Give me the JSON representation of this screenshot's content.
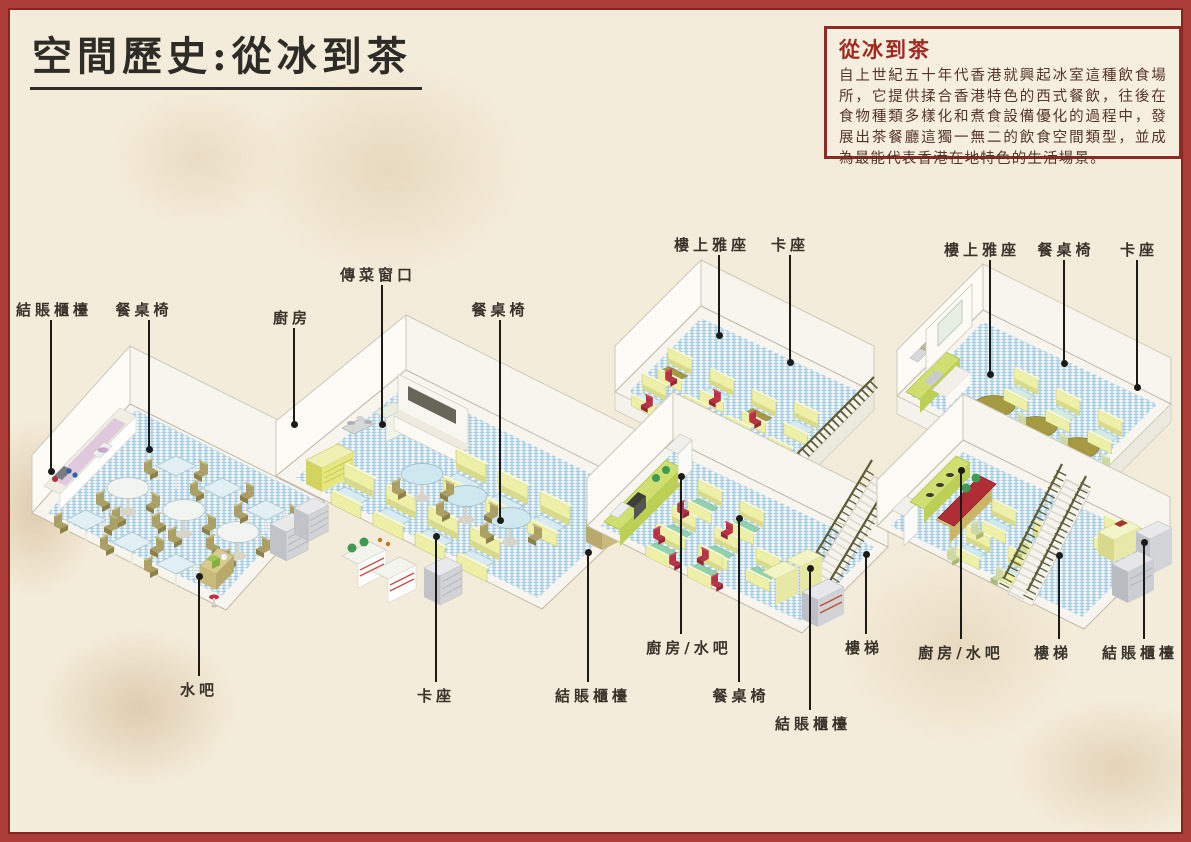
{
  "page": {
    "title": "空間歷史:從冰到茶"
  },
  "info_box": {
    "title": "從冰到茶",
    "body": "自上世紀五十年代香港就興起冰室這種飲食場所，它提供揉合香港特色的西式餐飲，往後在食物種類多樣化和煮食設備優化的過程中，發展出茶餐廳這獨一無二的飲食空間類型，並成為最能代表香港在地特色的生活場景。"
  },
  "labels": {
    "d1_checkout": "結賬櫃檯",
    "d1_tables": "餐桌椅",
    "d1_water_bar": "水吧",
    "d2_kitchen": "廚房",
    "d2_serving_window": "傳菜窗口",
    "d2_tables": "餐桌椅",
    "d2_booth": "卡座",
    "d2_checkout": "結賬櫃檯",
    "d3_upstairs": "樓上雅座",
    "d3_booth": "卡座",
    "d3_kitchen_bar": "廚房/水吧",
    "d3_tables": "餐桌椅",
    "d3_checkout": "結賬櫃檯",
    "d3_stairs": "樓梯",
    "d4_upstairs": "樓上雅座",
    "d4_tables": "餐桌椅",
    "d4_booth": "卡座",
    "d4_kitchen_bar": "廚房/水吧",
    "d4_stairs": "樓梯",
    "d4_checkout": "結賬櫃檯"
  },
  "colors": {
    "page_border": "#ab3c38",
    "box_border": "#8c2b23",
    "box_title_red": "#9e2b22",
    "body_text": "#55352c",
    "label_text": "#39332b",
    "floor_check_blue": "#a8cde2",
    "booth_bench_yellow": "#eef0a8",
    "wood_table": "#a59a41",
    "green_table": "#92d1ad",
    "red_chair": "#b73246",
    "accent_red": "#b02d35"
  }
}
